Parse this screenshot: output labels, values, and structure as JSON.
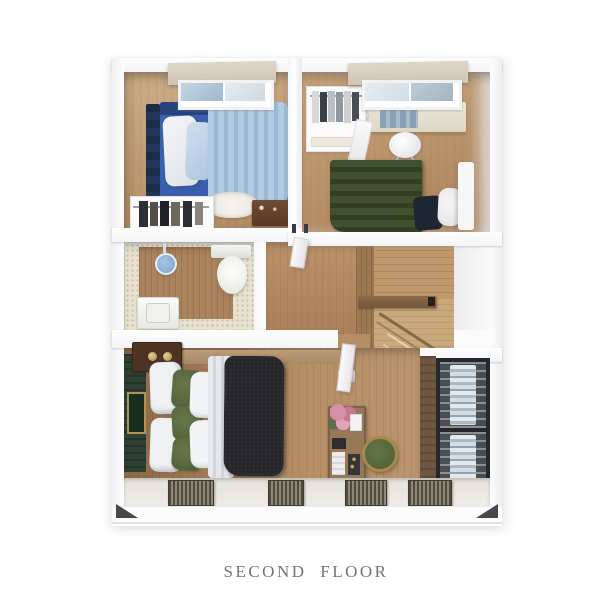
{
  "caption": {
    "text": "SECOND FLOOR",
    "color": "#73737a"
  },
  "floorplan": {
    "name": "second-floor-plan",
    "rooms": [
      {
        "name": "bedroom-top-left",
        "furniture": [
          "window",
          "single-bed-blue-bedding",
          "pillows",
          "clothes-rack",
          "shag-rug",
          "wooden-dresser"
        ]
      },
      {
        "name": "bedroom-top-right",
        "furniture": [
          "window",
          "desk",
          "desk-chair",
          "open-wardrobe-rack",
          "mirror",
          "bed-green-bedding"
        ]
      },
      {
        "name": "bathroom",
        "furniture": [
          "shower-head",
          "toilet",
          "sink-vanity",
          "glass-partition",
          "wood-accent-panel"
        ]
      },
      {
        "name": "hallway",
        "furniture": [
          "door-to-bedroom",
          "door-to-master-bedroom"
        ]
      },
      {
        "name": "staircase",
        "furniture": [
          "steps",
          "handrail",
          "wood-landing"
        ]
      },
      {
        "name": "master-bedroom",
        "furniture": [
          "double-bed",
          "green-accent-pillows",
          "dark-blanket",
          "headboard-wall-with-art",
          "nightstand-gramophone",
          "vanity-shelf-with-flowers",
          "round-stool",
          "wall-lamp"
        ]
      },
      {
        "name": "walk-in-closet",
        "furniture": [
          "wardrobe-with-hanging-clothes"
        ]
      },
      {
        "name": "balcony-ledge",
        "furniture": [
          "slatted-mats"
        ]
      }
    ],
    "colors": {
      "background": "#ffffff",
      "wall": "#fdfdfe",
      "wood_floor": "#b28a61",
      "wood_floor_dark": "#8c6846",
      "stair_wood": "#bf996c",
      "bathroom_tile": "#e9e2cf",
      "bed_blue": "#3a5fae",
      "duvet_light_blue": "#aac4de",
      "headboard_navy": "#1c2b4a",
      "bed_green": "#3e4b2d",
      "master_blanket_dark": "#26262b",
      "pillow_green": "#5a6a3e",
      "headboard_wall_green": "#2e4031",
      "stool_green": "#4c5c36",
      "closet_frame_dark": "#23282e",
      "flowers_pink": "#d98fa9"
    }
  }
}
